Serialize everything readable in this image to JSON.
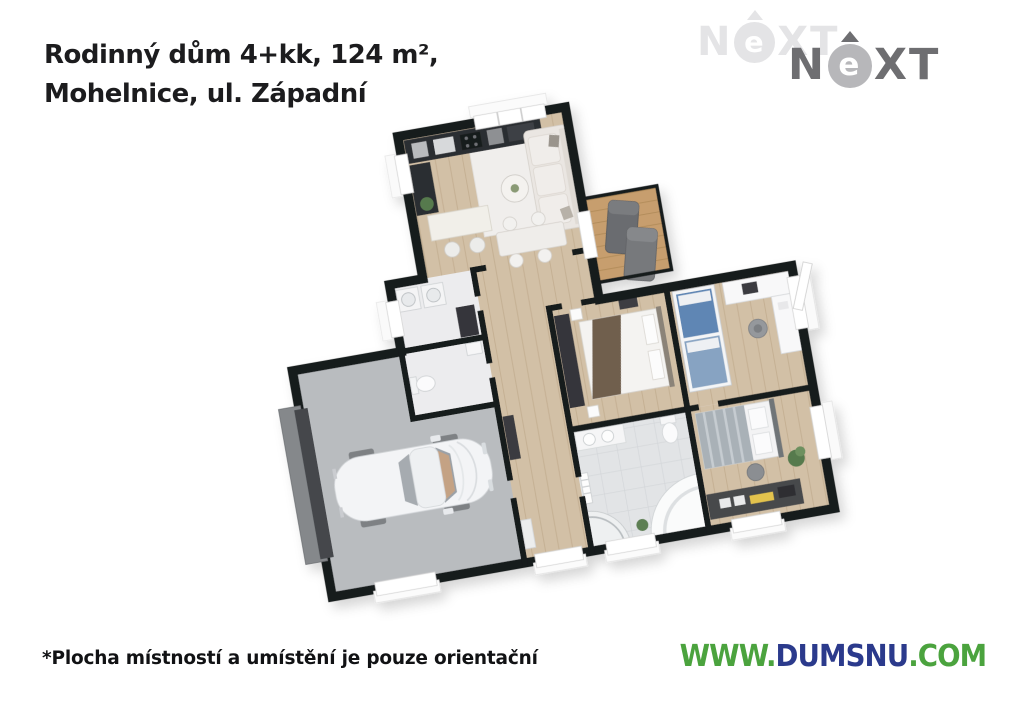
{
  "header": {
    "title_line1": "Rodinný dům 4+kk, 124 m²,",
    "title_line2": "Mohelnice, ul. Západní",
    "title_color": "#1c1c1e"
  },
  "brand": {
    "logo_n": "N",
    "logo_e": "e",
    "logo_xt": "XT",
    "light_logo_color": "#e4e4e6",
    "dark_logo_letter_color": "#6e6e71",
    "dark_logo_circle_color": "#b7b7ba"
  },
  "footer": {
    "disclaimer": "*Plocha místností a umístění je pouze orientační",
    "url_prefix": "WWW.",
    "url_name": "DUMSNU",
    "url_suffix": ".COM",
    "url_green": "#4ba33e",
    "url_navy": "#2b3a8c"
  },
  "floorplan": {
    "kind": "3d-rendered floor plan of a family house, tilted top-down view",
    "rooms": [
      "living-room-with-kitchen",
      "terrace",
      "hallway",
      "utility-room",
      "wc",
      "master-bedroom",
      "kids-room",
      "bedroom",
      "bathroom",
      "garage",
      "entry"
    ],
    "palette": {
      "walls": "#191a1e",
      "wood_floor": "#d2c0a6",
      "terrace_deck": "#c79e6e",
      "tile_floor": "#e2e4e6",
      "garage_floor": "#b9bcbf",
      "garage_door": "#44474b",
      "car_body": "#f3f4f6",
      "sofa": "#eae6e2",
      "master_blanket": "#705e4e",
      "bunk_bed_blue": "#5f86b4",
      "bed_gray": "#a9b1b7",
      "plant_green": "#567a4e"
    }
  }
}
